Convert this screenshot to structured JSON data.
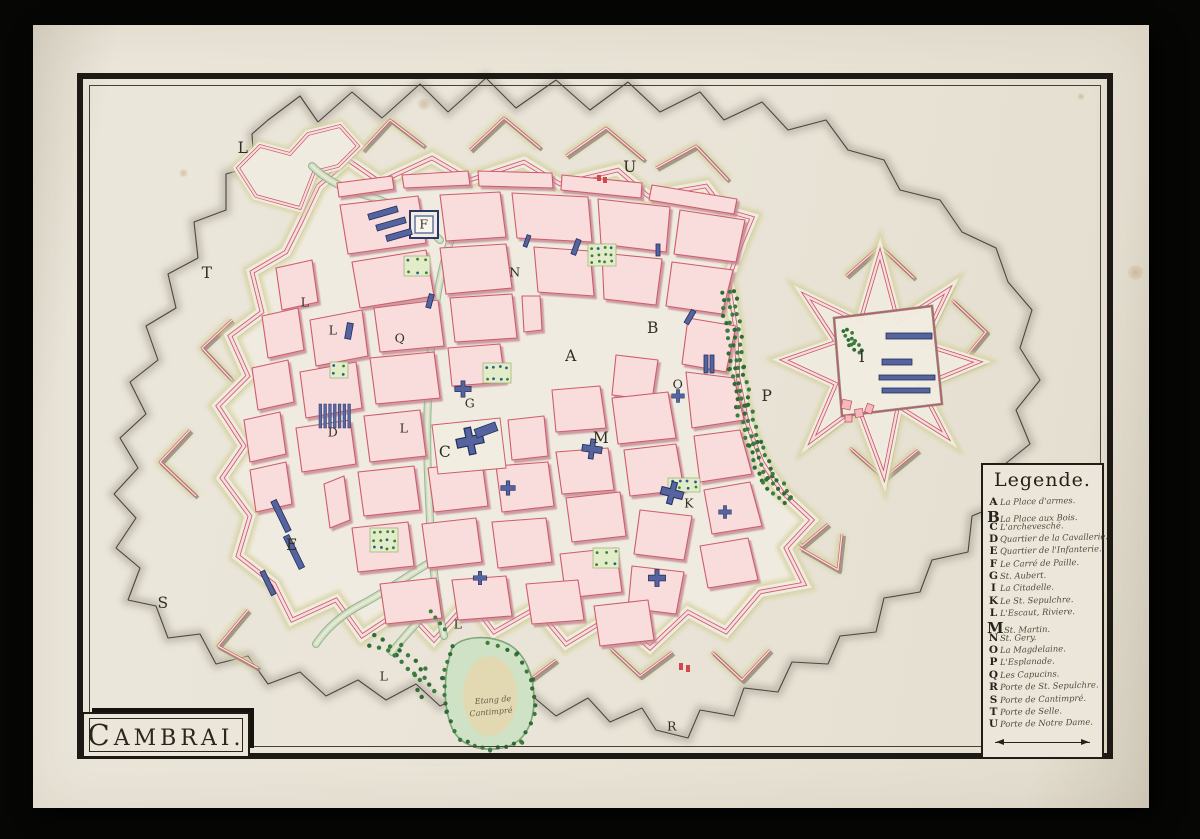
{
  "title_cartouche": {
    "text": "CAMBRAI."
  },
  "legend": {
    "title": "Legende.",
    "entries": [
      {
        "letter": "A",
        "label": "La Place d'armes."
      },
      {
        "letter": "B",
        "label": "La Place aux Bois."
      },
      {
        "letter": "C",
        "label": "L'archevesché."
      },
      {
        "letter": "D",
        "label": "Quartier de la Cavallerie."
      },
      {
        "letter": "E",
        "label": "Quartier de l'Infanterie."
      },
      {
        "letter": "F",
        "label": "Le Carré de Paille."
      },
      {
        "letter": "G",
        "label": "St. Aubert."
      },
      {
        "letter": "I",
        "label": "La Citadelle."
      },
      {
        "letter": "K",
        "label": "Le St. Sepulchre."
      },
      {
        "letter": "L",
        "label": "L'Escaut, Riviere."
      },
      {
        "letter": "M",
        "label": "St. Martin."
      },
      {
        "letter": "N",
        "label": "St. Gery."
      },
      {
        "letter": "O",
        "label": "La Magdelaine."
      },
      {
        "letter": "P",
        "label": "L'Esplanade."
      },
      {
        "letter": "Q",
        "label": "Les Capucins."
      },
      {
        "letter": "R",
        "label": "Porte de St. Sepulchre."
      },
      {
        "letter": "S",
        "label": "Porte de Cantimpré."
      },
      {
        "letter": "T",
        "label": "Porte de Selle."
      },
      {
        "letter": "U",
        "label": "Porte de Notre Dame."
      }
    ]
  },
  "map": {
    "markers": [
      {
        "ch": "L",
        "x": 243,
        "y": 148,
        "big": true
      },
      {
        "ch": "U",
        "x": 630,
        "y": 167,
        "big": true
      },
      {
        "ch": "T",
        "x": 207,
        "y": 273,
        "big": true
      },
      {
        "ch": "L",
        "x": 305,
        "y": 302
      },
      {
        "ch": "L",
        "x": 333,
        "y": 330
      },
      {
        "ch": "Q",
        "x": 400,
        "y": 338
      },
      {
        "ch": "N",
        "x": 515,
        "y": 272
      },
      {
        "ch": "F",
        "x": 424,
        "y": 224
      },
      {
        "ch": "A",
        "x": 571,
        "y": 356,
        "big": true
      },
      {
        "ch": "B",
        "x": 653,
        "y": 328,
        "big": true
      },
      {
        "ch": "G",
        "x": 470,
        "y": 403
      },
      {
        "ch": "O",
        "x": 678,
        "y": 384
      },
      {
        "ch": "P",
        "x": 767,
        "y": 396,
        "big": true
      },
      {
        "ch": "I",
        "x": 862,
        "y": 357,
        "big": true
      },
      {
        "ch": "M",
        "x": 601,
        "y": 438,
        "big": true
      },
      {
        "ch": "C",
        "x": 445,
        "y": 452,
        "big": true
      },
      {
        "ch": "D",
        "x": 333,
        "y": 432
      },
      {
        "ch": "K",
        "x": 689,
        "y": 503
      },
      {
        "ch": "E",
        "x": 292,
        "y": 545,
        "big": true
      },
      {
        "ch": "S",
        "x": 163,
        "y": 603,
        "big": true
      },
      {
        "ch": "L",
        "x": 404,
        "y": 428
      },
      {
        "ch": "L",
        "x": 458,
        "y": 624
      },
      {
        "ch": "L",
        "x": 384,
        "y": 676
      },
      {
        "ch": "R",
        "x": 672,
        "y": 726
      }
    ],
    "annotations": [
      {
        "text": "Etang de",
        "x": 493,
        "y": 700
      },
      {
        "text": "Cantimpré",
        "x": 491,
        "y": 712
      }
    ]
  },
  "colors": {
    "paper": "#e9e4d7",
    "frame_ink": "#1d1a15",
    "block_fill": "#f9dcdc",
    "block_edge": "#cf5c6c",
    "rampart_crimson": "#c95666",
    "glacis_olive": "#d5d2a2",
    "shadow_grey": "#8e8477",
    "tree_green": "#2f6b33",
    "water_green": "#c9dfc4",
    "pond_tan": "#e4d8b0",
    "building_blue": "#55649e"
  }
}
